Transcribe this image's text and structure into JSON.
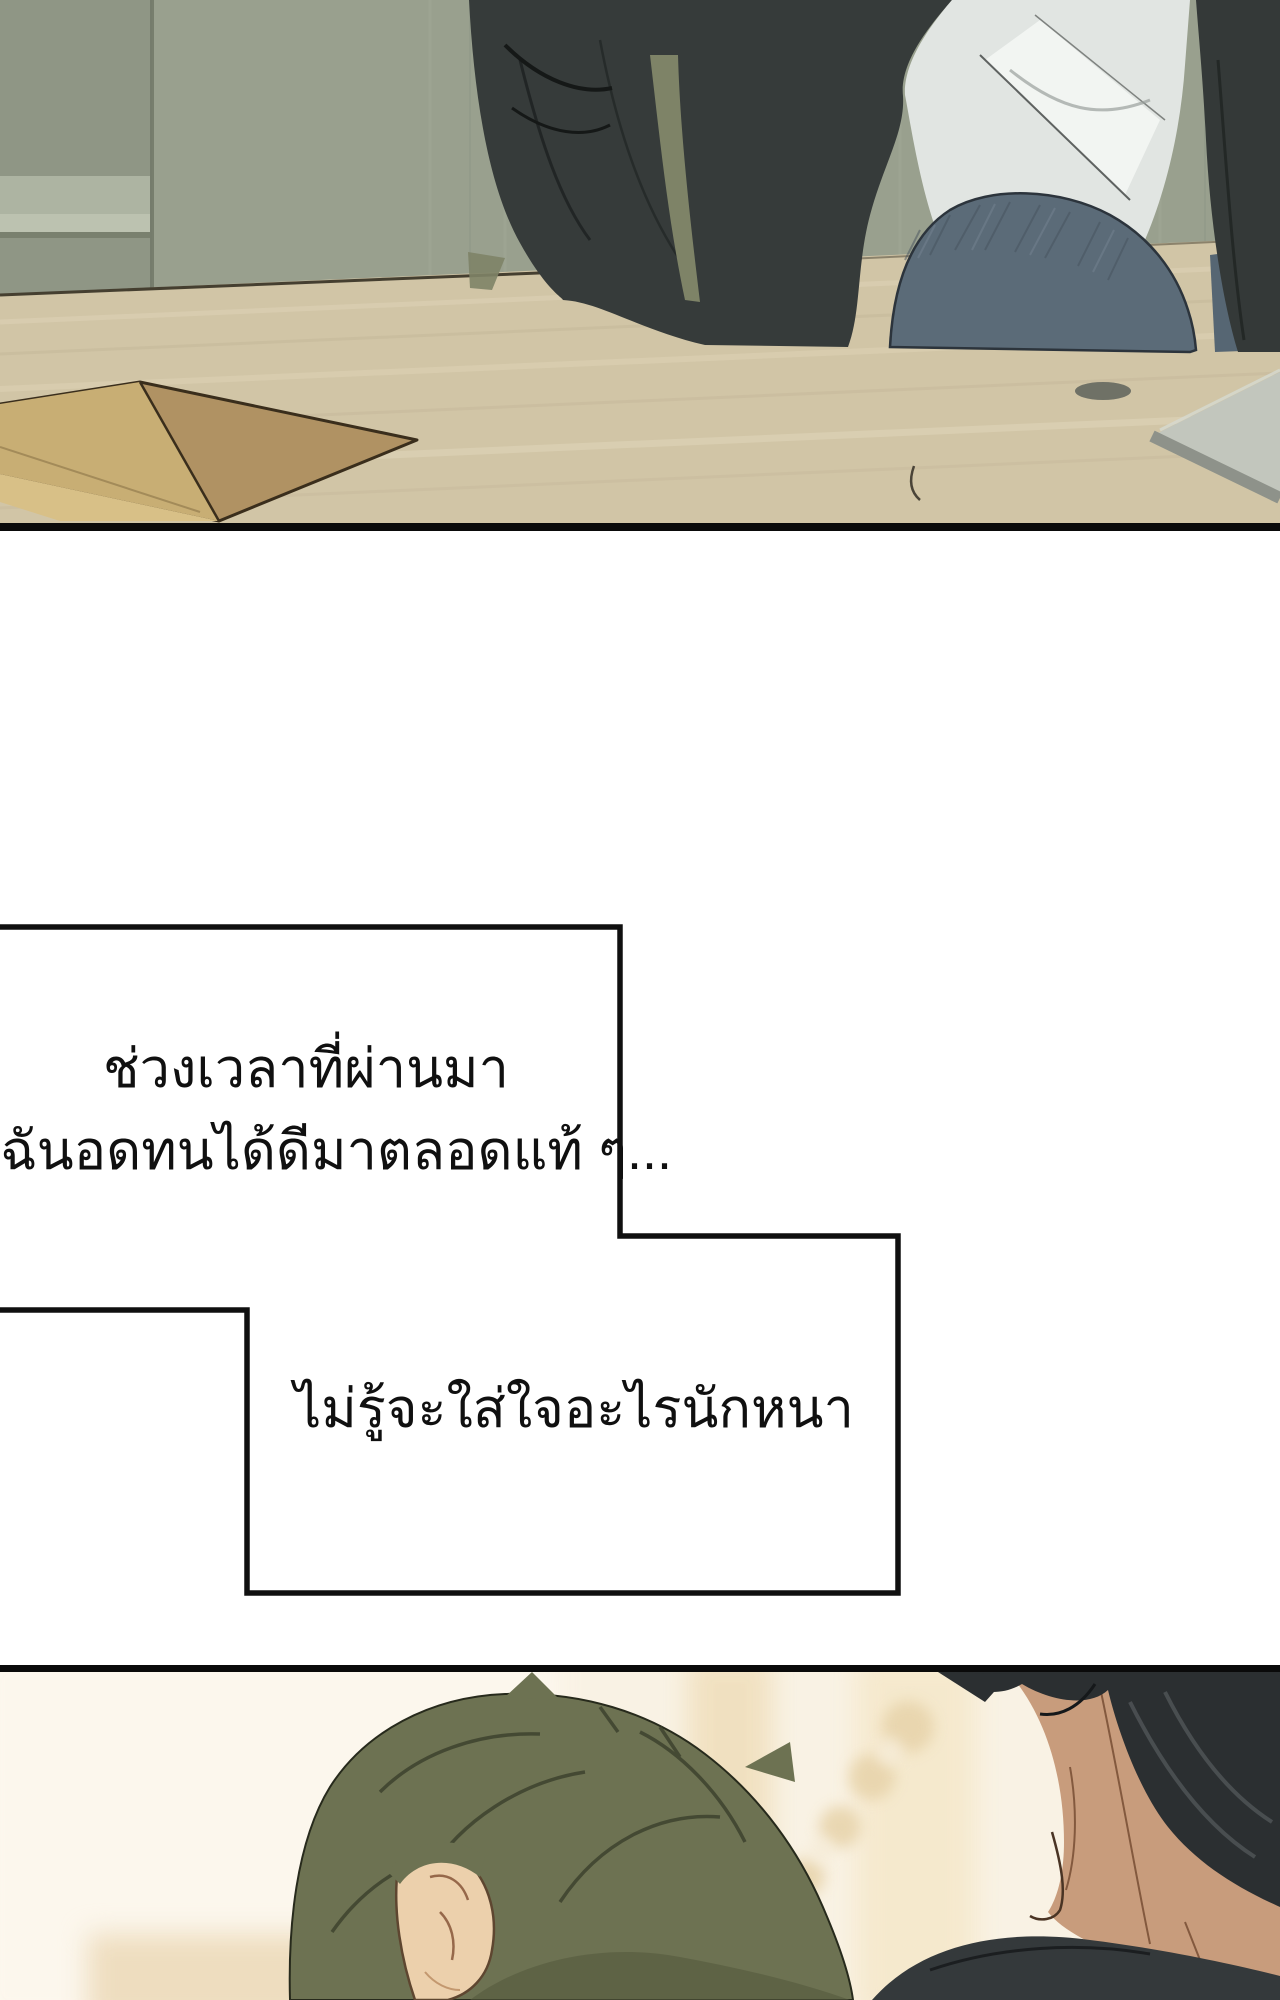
{
  "page": {
    "kind": "webtoon comic page",
    "width_px": 1280,
    "height_px": 2000,
    "background": "#ffffff"
  },
  "narration": {
    "box1": {
      "line1": "ช่วงเวลาที่ผ่านมา",
      "line2": "ฉันอดทนได้ดีมาตลอดแท้ ๆ..."
    },
    "box2": {
      "text": "ไม่รู้จะใส่ใจอะไรนักหนา"
    }
  },
  "panels": [
    {
      "id": "panel-1",
      "description": "man in dark jacket, white shirt and jeans seated at a pale wooden table; brown envelope at left, gray notebook at right, green-gray wall behind"
    },
    {
      "id": "narration-boxes",
      "description": "two overlapping white narration boxes with black outline on white gutter"
    },
    {
      "id": "panel-2",
      "description": "back of a man with olive-green hair facing a dark-haired man in a dark jacket; warm cream blurred interior background"
    }
  ],
  "palette": {
    "panel_border": "#0a0a0a",
    "box_border": "#101010",
    "wall_left": "#8f9685",
    "wall_right": "#99a08e",
    "wall_band": "#adb4a2",
    "table_wood": "#d1c5a6",
    "envelope_light": "#c8ae74",
    "envelope_dark": "#b09263",
    "jacket": "#363b3a",
    "shirt": "#e1e5e2",
    "jeans": "#5b6b78",
    "notebook": "#c2c6bd",
    "panel3_bg": "#f9f2e4",
    "hair_green": "#6d7252",
    "hair_black": "#2b2f31",
    "skin_light": "#ecd0ac",
    "skin_tan": "#c89c7c"
  }
}
